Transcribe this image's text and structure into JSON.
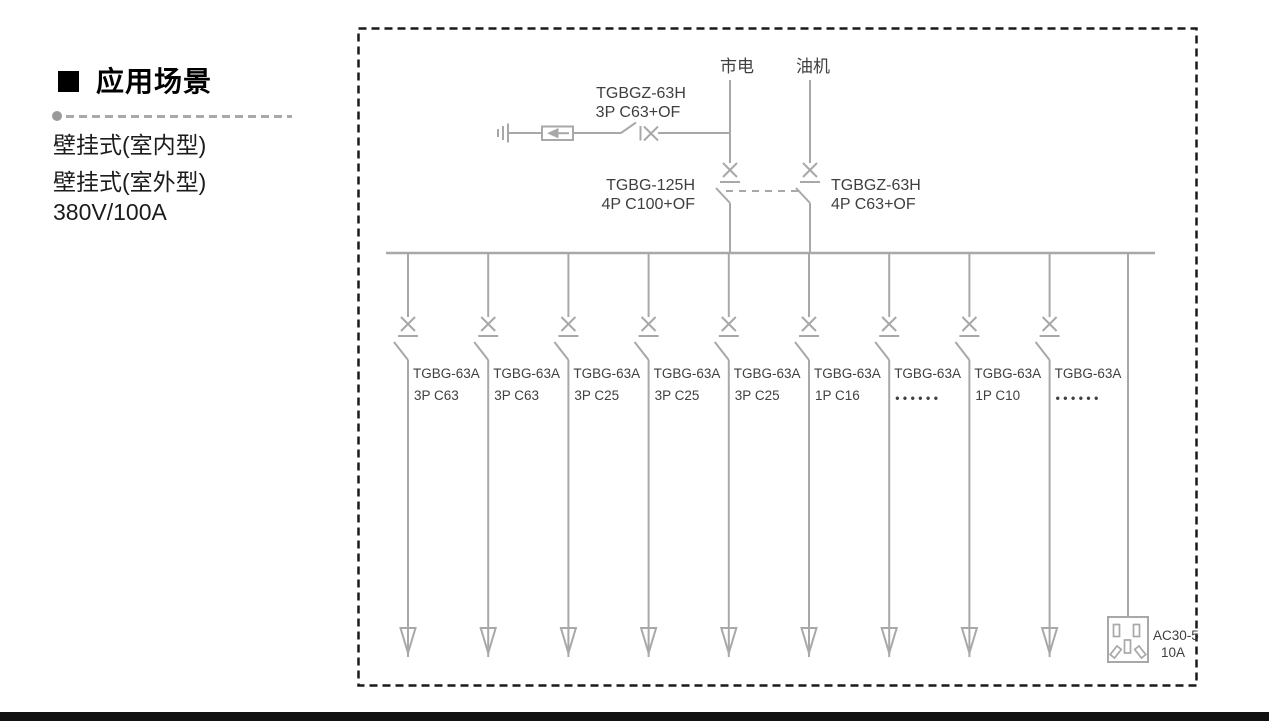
{
  "sidebar": {
    "heading": "应用场景",
    "items": [
      "壁挂式(室内型)",
      "壁挂式(室外型)",
      "380V/100A"
    ]
  },
  "diagram": {
    "mains_label": "市电",
    "generator_label": "油机",
    "spd_breaker": {
      "line1": "TGBGZ-63H",
      "line2": "3P C63+OF"
    },
    "mains_breaker": {
      "line1": "TGBG-125H",
      "line2": "4P C100+OF"
    },
    "generator_breaker": {
      "line1": "TGBGZ-63H",
      "line2": "4P C63+OF"
    },
    "branches": [
      {
        "model": "TGBG-63A",
        "spec": "3P C63"
      },
      {
        "model": "TGBG-63A",
        "spec": "3P C63"
      },
      {
        "model": "TGBG-63A",
        "spec": "3P C25"
      },
      {
        "model": "TGBG-63A",
        "spec": "3P C25"
      },
      {
        "model": "TGBG-63A",
        "spec": "3P C25"
      },
      {
        "model": "TGBG-63A",
        "spec": "1P C16"
      },
      {
        "model": "TGBG-63A",
        "spec": "••••••",
        "dots": true
      },
      {
        "model": "TGBG-63A",
        "spec": "1P C10"
      },
      {
        "model": "TGBG-63A",
        "spec": "••••••",
        "dots": true
      }
    ],
    "socket": {
      "line1": "AC30-5",
      "line2": "10A"
    }
  },
  "colors": {
    "line": "#a8a8a8",
    "diagram_text": "#3f3f3f",
    "border_dash": "#1a1a1a",
    "bottom_bar": "#111111"
  }
}
